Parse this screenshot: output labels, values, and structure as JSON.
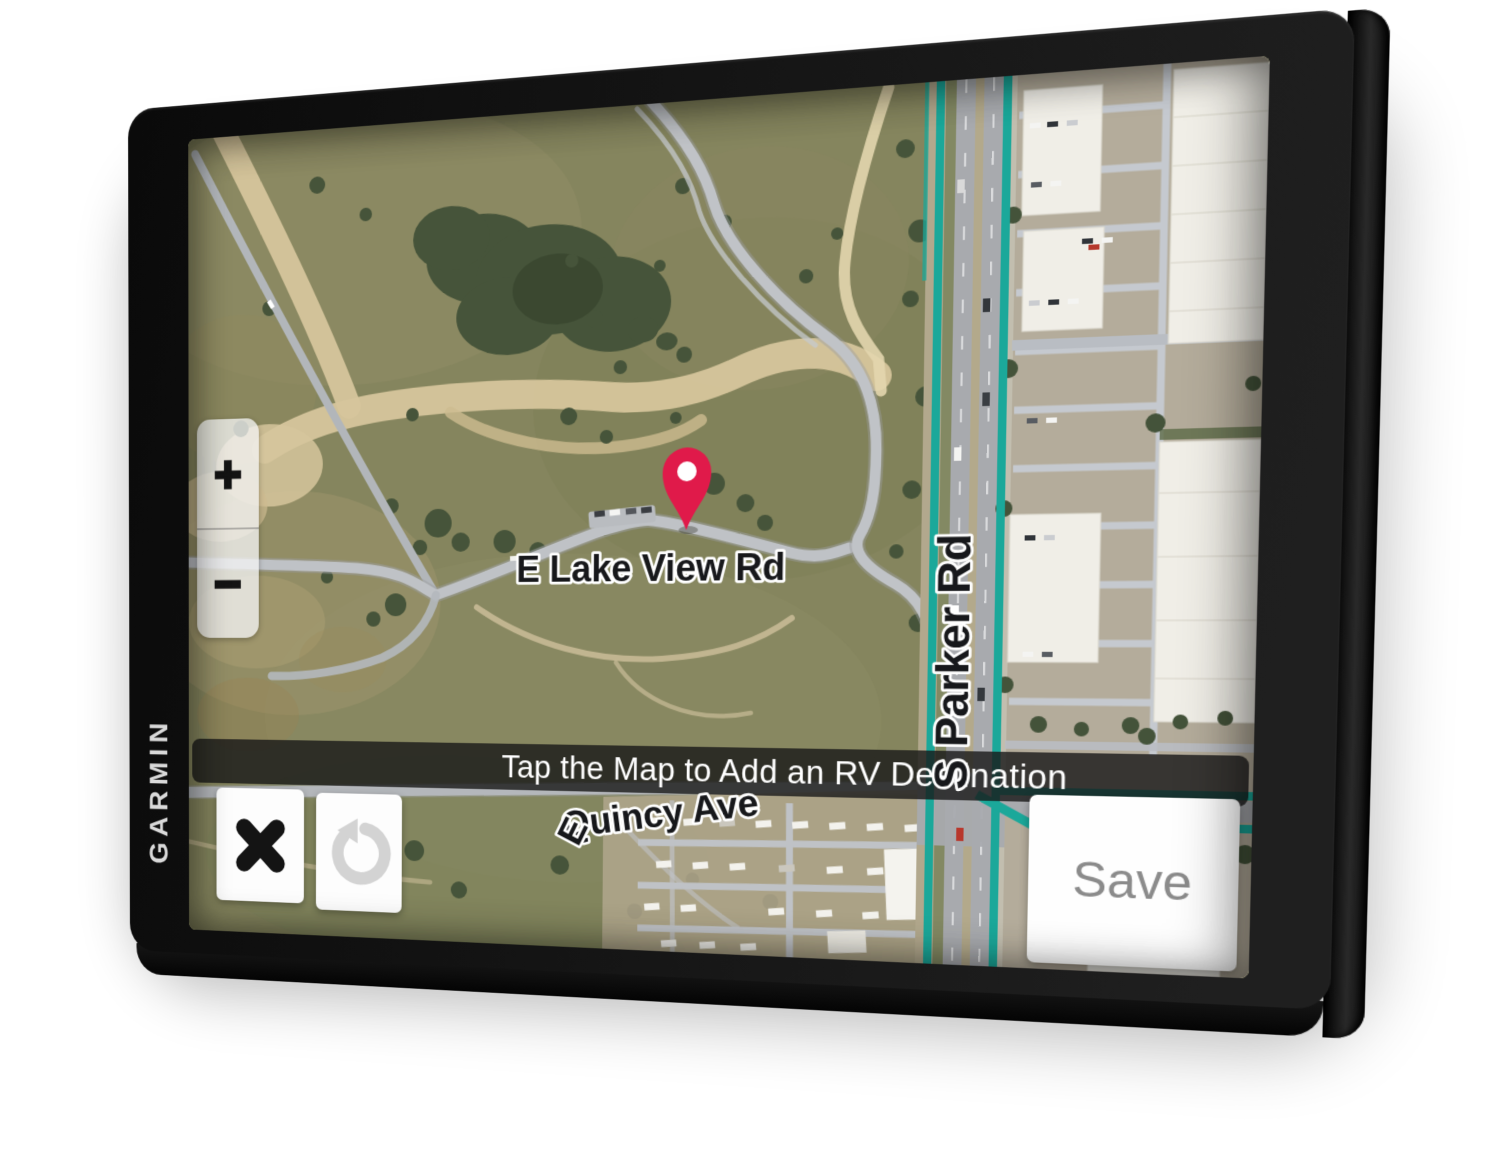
{
  "device": {
    "brand": "GARMIN"
  },
  "map": {
    "banner_text": "Tap the Map to Add an RV Destination",
    "road_labels": {
      "lake_view": "E Lake View Rd",
      "quincy_prefix": "E",
      "quincy": "Quincy Ave",
      "parker": "S Parker Rd"
    },
    "marker": {
      "name": "rv-destination-pin",
      "color": "#E01A4A"
    }
  },
  "controls": {
    "zoom_in_label": "+",
    "zoom_out_label": "−",
    "save_label": "Save",
    "close_icon": "x-icon",
    "undo_icon": "undo-arrow-icon"
  },
  "colors": {
    "route_highlight_teal": "#1BA89A",
    "banner_background": "rgba(24,24,24,0.8)",
    "bezel_black": "#111111"
  }
}
